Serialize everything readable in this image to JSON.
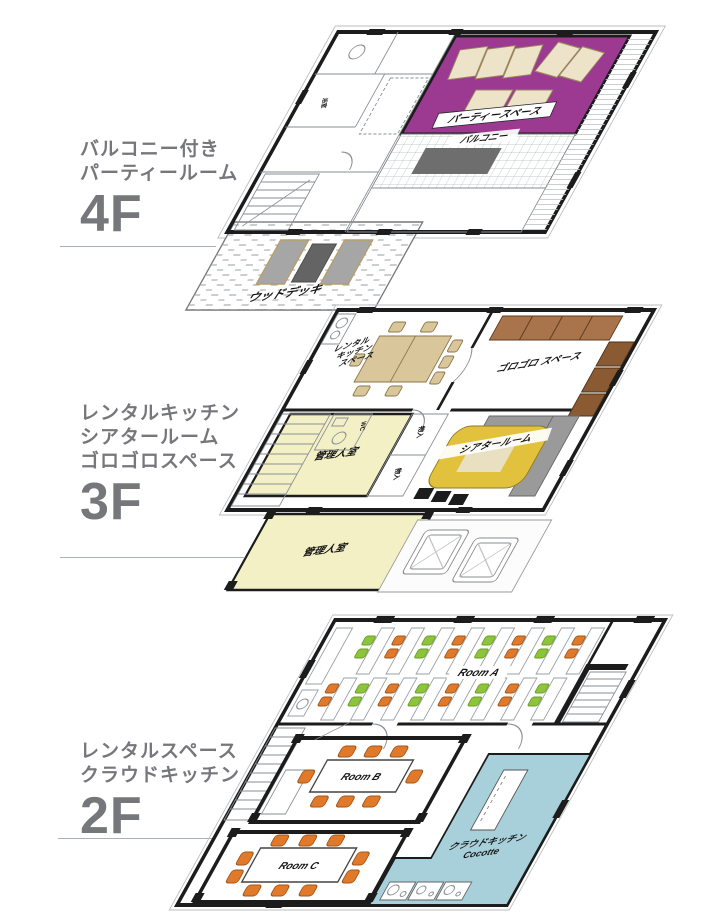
{
  "colors": {
    "purple": "#9c3a92",
    "tan": "#d9c79b",
    "mat-brown": "#a9734b",
    "sofa-brown": "#8a5a33",
    "pale-yellow": "#f4f0c6",
    "gold": "#e2c23c",
    "beige": "#e9e0c2",
    "blue": "#a7d0da",
    "green": "#8cc43c",
    "orange": "#e07a2a",
    "label-gray": "#76777a",
    "wall": "#1c1c1c",
    "gray-panel": "#9a9a9a",
    "deck-mat": "#a6a6a6",
    "deck-mat-dark": "#646464",
    "balcony-table": "#6e6e6e"
  },
  "floors": [
    {
      "floor_no": "4F",
      "label_lines": [
        "バルコニー付き",
        "パーティールーム"
      ],
      "rooms": {
        "party_space": "パーティースペース",
        "balcony": "バルコニー",
        "wood_deck": "ウッドデッキ",
        "bath": "浴室"
      }
    },
    {
      "floor_no": "3F",
      "label_lines": [
        "レンタルキッチン",
        "シアタールーム",
        "ゴロゴロスペース"
      ],
      "rooms": {
        "rental_kitchen": [
          "レンタル",
          "キッチン",
          "スペース"
        ],
        "gorogoro": "ゴロゴロ スペース",
        "manager_upper": "管理人室",
        "manager_lower": "管理人室",
        "theater": "シアタールーム",
        "closet_a": "物入",
        "closet_b": "物入",
        "wc": "WC"
      }
    },
    {
      "floor_no": "2F",
      "label_lines": [
        "レンタルスペース",
        "クラウドキッチン"
      ],
      "rooms": {
        "room_a": "Room A",
        "room_b": "Room B",
        "room_c": "Room C",
        "cloud_kitchen_line1": "クラウドキッチン",
        "cloud_kitchen_line2": "Cocotte"
      }
    }
  ]
}
